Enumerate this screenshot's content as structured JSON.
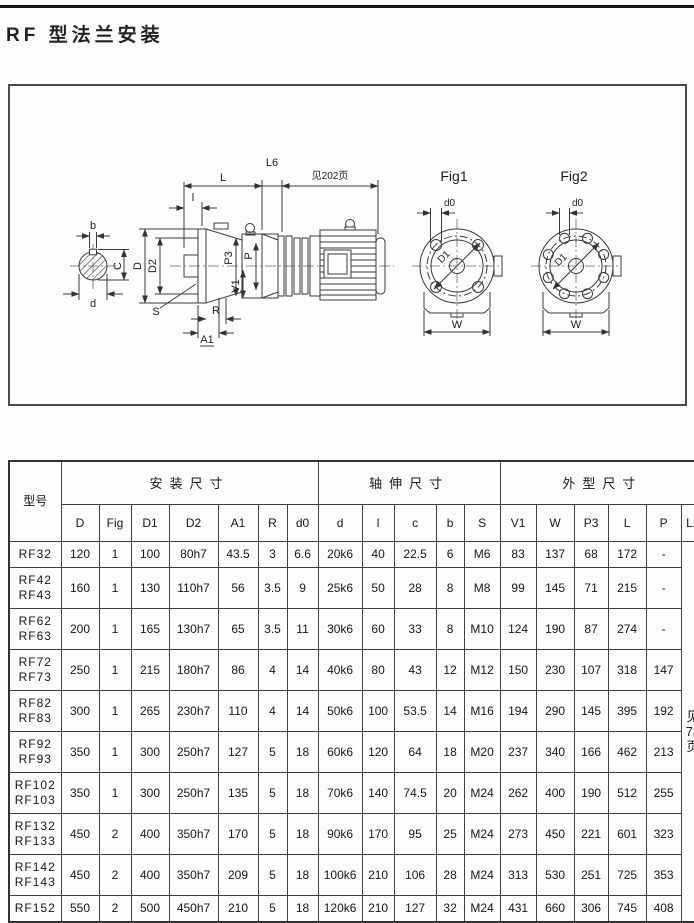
{
  "page": {
    "title": "RF 型法兰安装"
  },
  "drawing": {
    "labels": {
      "L": "L",
      "L6": "L6",
      "see_page": "见202页",
      "l": "l",
      "b": "b",
      "C": "C",
      "d": "d",
      "D": "D",
      "D2": "D2",
      "S": "S",
      "A1": "A1",
      "R": "R",
      "P3": "P3",
      "P": "P",
      "V1": "V1",
      "fig1": "Fig1",
      "fig2": "Fig2",
      "d0_fig1": "d0",
      "d0_fig2": "d0",
      "D1_fig1": "D1",
      "D1_fig2": "D1",
      "W_fig1": "W",
      "W_fig2": "W"
    }
  },
  "table": {
    "col_model": "型号",
    "groups": [
      {
        "label": "安装尺寸",
        "cols": [
          "D",
          "Fig",
          "D1",
          "D2",
          "A1",
          "R",
          "d0"
        ]
      },
      {
        "label": "轴伸尺寸",
        "cols": [
          "d",
          "l",
          "c",
          "b",
          "S"
        ]
      },
      {
        "label": "外型尺寸",
        "cols": [
          "V1",
          "W",
          "P3",
          "L",
          "P",
          "L2"
        ]
      }
    ],
    "l2_note": "见\n72\n页",
    "rows": [
      {
        "model": "RF32",
        "values": [
          "120",
          "1",
          "100",
          "80h7",
          "43.5",
          "3",
          "6.6",
          "20k6",
          "40",
          "22.5",
          "6",
          "M6",
          "83",
          "137",
          "68",
          "172",
          "-"
        ]
      },
      {
        "model": "RF42\nRF43",
        "values": [
          "160",
          "1",
          "130",
          "110h7",
          "56",
          "3.5",
          "9",
          "25k6",
          "50",
          "28",
          "8",
          "M8",
          "99",
          "145",
          "71",
          "215",
          "-"
        ]
      },
      {
        "model": "RF62\nRF63",
        "values": [
          "200",
          "1",
          "165",
          "130h7",
          "65",
          "3.5",
          "11",
          "30k6",
          "60",
          "33",
          "8",
          "M10",
          "124",
          "190",
          "87",
          "274",
          "-"
        ]
      },
      {
        "model": "RF72\nRF73",
        "values": [
          "250",
          "1",
          "215",
          "180h7",
          "86",
          "4",
          "14",
          "40k6",
          "80",
          "43",
          "12",
          "M12",
          "150",
          "230",
          "107",
          "318",
          "147"
        ]
      },
      {
        "model": "RF82\nRF83",
        "values": [
          "300",
          "1",
          "265",
          "230h7",
          "110",
          "4",
          "14",
          "50k6",
          "100",
          "53.5",
          "14",
          "M16",
          "194",
          "290",
          "145",
          "395",
          "192"
        ]
      },
      {
        "model": "RF92\nRF93",
        "values": [
          "350",
          "1",
          "300",
          "250h7",
          "127",
          "5",
          "18",
          "60k6",
          "120",
          "64",
          "18",
          "M20",
          "237",
          "340",
          "166",
          "462",
          "213"
        ]
      },
      {
        "model": "RF102\nRF103",
        "values": [
          "350",
          "1",
          "300",
          "250h7",
          "135",
          "5",
          "18",
          "70k6",
          "140",
          "74.5",
          "20",
          "M24",
          "262",
          "400",
          "190",
          "512",
          "255"
        ]
      },
      {
        "model": "RF132\nRF133",
        "values": [
          "450",
          "2",
          "400",
          "350h7",
          "170",
          "5",
          "18",
          "90k6",
          "170",
          "95",
          "25",
          "M24",
          "273",
          "450",
          "221",
          "601",
          "323"
        ]
      },
      {
        "model": "RF142\nRF143",
        "values": [
          "450",
          "2",
          "400",
          "350h7",
          "209",
          "5",
          "18",
          "100k6",
          "210",
          "106",
          "28",
          "M24",
          "313",
          "530",
          "251",
          "725",
          "353"
        ]
      },
      {
        "model": "RF152",
        "values": [
          "550",
          "2",
          "500",
          "450h7",
          "210",
          "5",
          "18",
          "120k6",
          "210",
          "127",
          "32",
          "M24",
          "431",
          "660",
          "306",
          "745",
          "408"
        ]
      }
    ]
  }
}
